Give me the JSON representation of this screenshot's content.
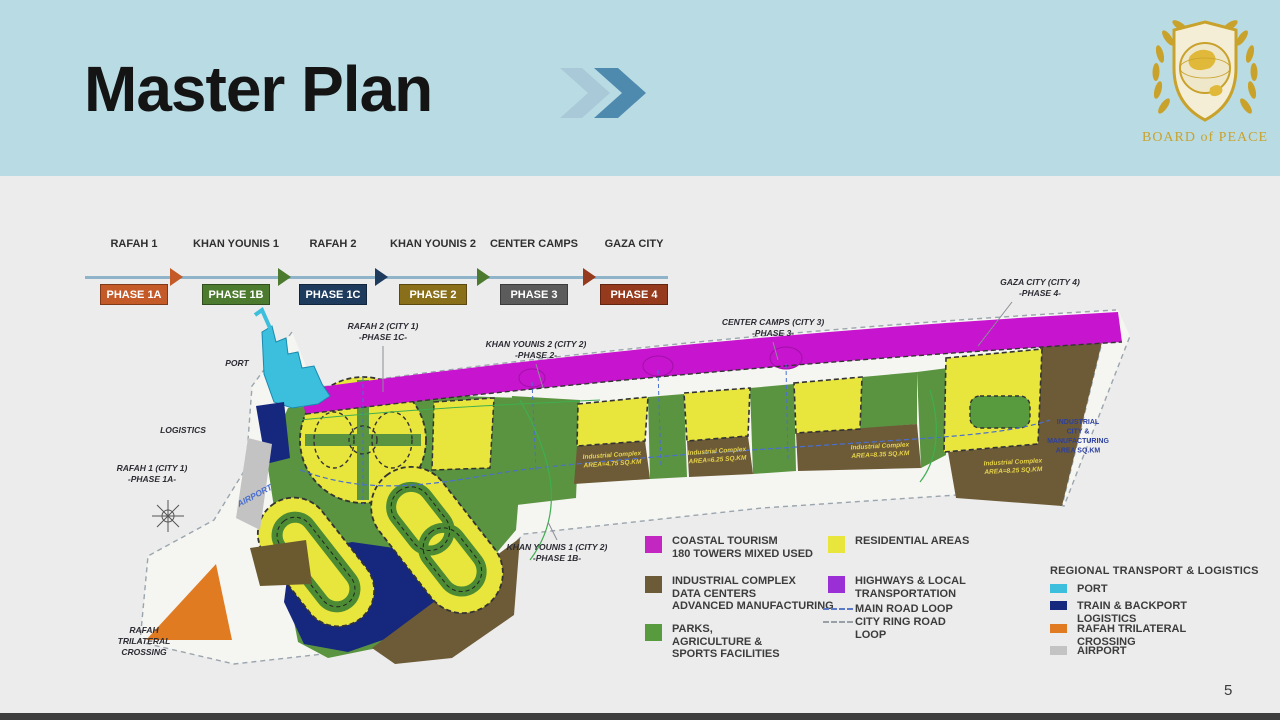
{
  "page": {
    "number": "5"
  },
  "header": {
    "title": "Master Plan"
  },
  "logo": {
    "caption": "BOARD of PEACE"
  },
  "timeline": {
    "items": [
      {
        "city": "RAFAH 1",
        "sub": "CITY 1",
        "phase": "PHASE 1A",
        "color": "#c45a27"
      },
      {
        "city": "KHAN YOUNIS 1",
        "sub": "CITY 2",
        "phase": "PHASE 1B",
        "color": "#4c7a2f"
      },
      {
        "city": "RAFAH 2",
        "sub": "CITY 1",
        "phase": "PHASE 1C",
        "color": "#1e3a5d"
      },
      {
        "city": "KHAN YOUNIS 2",
        "sub": "CITY 2",
        "phase": "PHASE 2",
        "color": "#8a6f1a"
      },
      {
        "city": "CENTER CAMPS",
        "sub": "CITY 3",
        "phase": "PHASE 3",
        "color": "#5b5b5b"
      },
      {
        "city": "GAZA CITY",
        "sub": "CITY 4",
        "phase": "PHASE 4",
        "color": "#953a1d"
      }
    ],
    "arrow_colors": [
      "#c45a27",
      "#4c7a2f",
      "#1e3a5d",
      "#4c7a2f",
      "#953a1d"
    ]
  },
  "map": {
    "labels": [
      {
        "id": "port",
        "lines": [
          "PORT"
        ]
      },
      {
        "id": "logistics",
        "lines": [
          "LOGISTICS"
        ]
      },
      {
        "id": "rafah1",
        "lines": [
          "RAFAH 1 (CITY 1)",
          "-PHASE 1A-"
        ]
      },
      {
        "id": "rafah-crossing",
        "lines": [
          "RAFAH",
          "TRILATERAL",
          "CROSSING"
        ]
      },
      {
        "id": "rafah2",
        "lines": [
          "RAFAH 2 (CITY 1)",
          "-PHASE 1C-"
        ]
      },
      {
        "id": "khan-younis-2",
        "lines": [
          "KHAN YOUNIS 2 (CITY 2)",
          "-PHASE 2-"
        ]
      },
      {
        "id": "center-camps",
        "lines": [
          "CENTER CAMPS (CITY 3)",
          "-PHASE 3-"
        ]
      },
      {
        "id": "gaza-city",
        "lines": [
          "GAZA CITY (CITY 4)",
          "-PHASE 4-"
        ]
      },
      {
        "id": "khan-younis-1",
        "lines": [
          "KHAN YOUNIS 1 (CITY 2)",
          "-PHASE 1B-"
        ]
      },
      {
        "id": "airport",
        "lines": [
          "AIRPORT"
        ]
      }
    ],
    "industrial_labels": [
      {
        "id": "industrial-1",
        "lines": [
          "Industrial Complex",
          "AREA=4.75 SQ.KM"
        ]
      },
      {
        "id": "industrial-2",
        "lines": [
          "Industrial Complex",
          "AREA=6.25 SQ.KM"
        ]
      },
      {
        "id": "industrial-3",
        "lines": [
          "Industrial Complex",
          "AREA=8.35 SQ.KM"
        ]
      },
      {
        "id": "industrial-4",
        "lines": [
          "Industrial Complex",
          "AREA=8.25 SQ.KM"
        ]
      }
    ],
    "industrial_city_note": {
      "lines": [
        "INDUSTRIAL",
        "CITY &",
        "MANUFACTURING",
        "AREA SQ.KM"
      ]
    }
  },
  "legend_zones": {
    "col1": [
      {
        "color": "#c227c2",
        "lines": [
          "COASTAL TOURISM",
          "180 TOWERS MIXED USED"
        ]
      },
      {
        "color": "#6d5b38",
        "lines": [
          "INDUSTRIAL COMPLEX",
          "DATA CENTERS",
          "ADVANCED MANUFACTURING"
        ]
      },
      {
        "color": "#579b3e",
        "lines": [
          "PARKS,",
          "AGRICULTURE &",
          "SPORTS FACILITIES"
        ]
      }
    ],
    "col2": [
      {
        "color": "#e8e53d",
        "lines": [
          "RESIDENTIAL AREAS"
        ]
      },
      {
        "color": "#9a2fd6",
        "lines": [
          "HIGHWAYS & LOCAL",
          "TRANSPORTATION"
        ]
      },
      {
        "dash": "#5b79c9",
        "lines": [
          "MAIN ROAD LOOP"
        ]
      },
      {
        "dash": "#9aa0a8",
        "lines": [
          "CITY RING ROAD",
          "LOOP"
        ]
      }
    ]
  },
  "legend_regional": {
    "title": "REGIONAL TRANSPORT & LOGISTICS",
    "items": [
      {
        "color": "#3bbfdc",
        "lines": [
          "PORT"
        ]
      },
      {
        "color": "#16277e",
        "lines": [
          "TRAIN & BACKPORT",
          "LOGISTICS"
        ]
      },
      {
        "color": "#e07b22",
        "lines": [
          "RAFAH TRILATERAL",
          "CROSSING"
        ]
      },
      {
        "color": "#c3c3c3",
        "lines": [
          "AIRPORT"
        ]
      }
    ]
  }
}
